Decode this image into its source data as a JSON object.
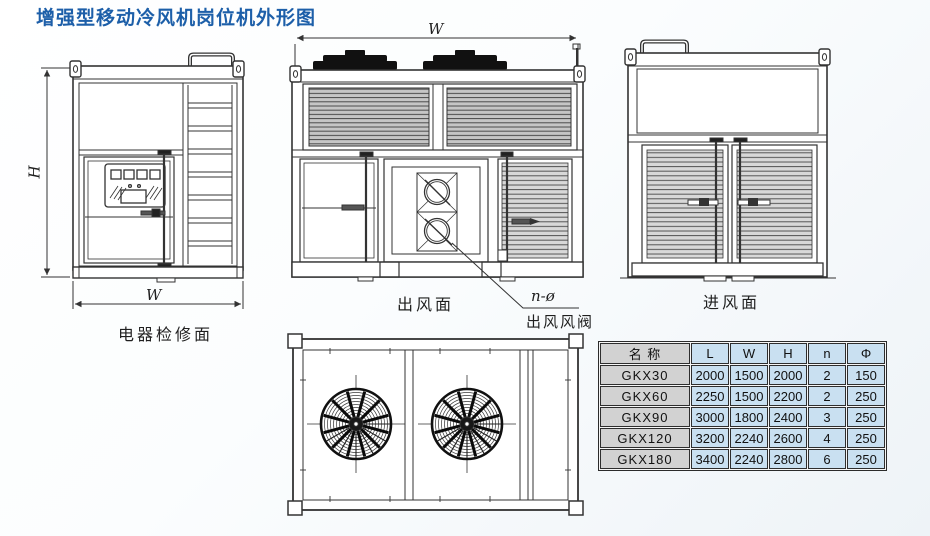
{
  "title": "增强型移动冷风机岗位机外形图",
  "views": {
    "electrical": {
      "label": "电器检修面",
      "dim_height": "H",
      "dim_width": "W"
    },
    "outlet": {
      "label": "出风面",
      "dim_width": "W",
      "callout": "n-ø",
      "callout_name": "出风风阀"
    },
    "inlet": {
      "label": "进风面"
    },
    "top": {
      "description": "top view with two fan grilles"
    }
  },
  "table": {
    "headers": [
      "名 称",
      "L",
      "W",
      "H",
      "n",
      "Φ"
    ],
    "rows": [
      [
        "GKX30",
        "2000",
        "1500",
        "2000",
        "2",
        "150"
      ],
      [
        "GKX60",
        "2250",
        "1500",
        "2200",
        "2",
        "250"
      ],
      [
        "GKX90",
        "3000",
        "1800",
        "2400",
        "3",
        "250"
      ],
      [
        "GKX120",
        "3200",
        "2240",
        "2600",
        "4",
        "250"
      ],
      [
        "GKX180",
        "3400",
        "2240",
        "2800",
        "6",
        "250"
      ]
    ]
  },
  "colors": {
    "title_blue": "#1d5fa9",
    "table_name_gray": "#d2d2d2",
    "table_cell_blue": "#c9e0f1",
    "line": "#333333",
    "louver_gray": "#c6c6c6"
  }
}
